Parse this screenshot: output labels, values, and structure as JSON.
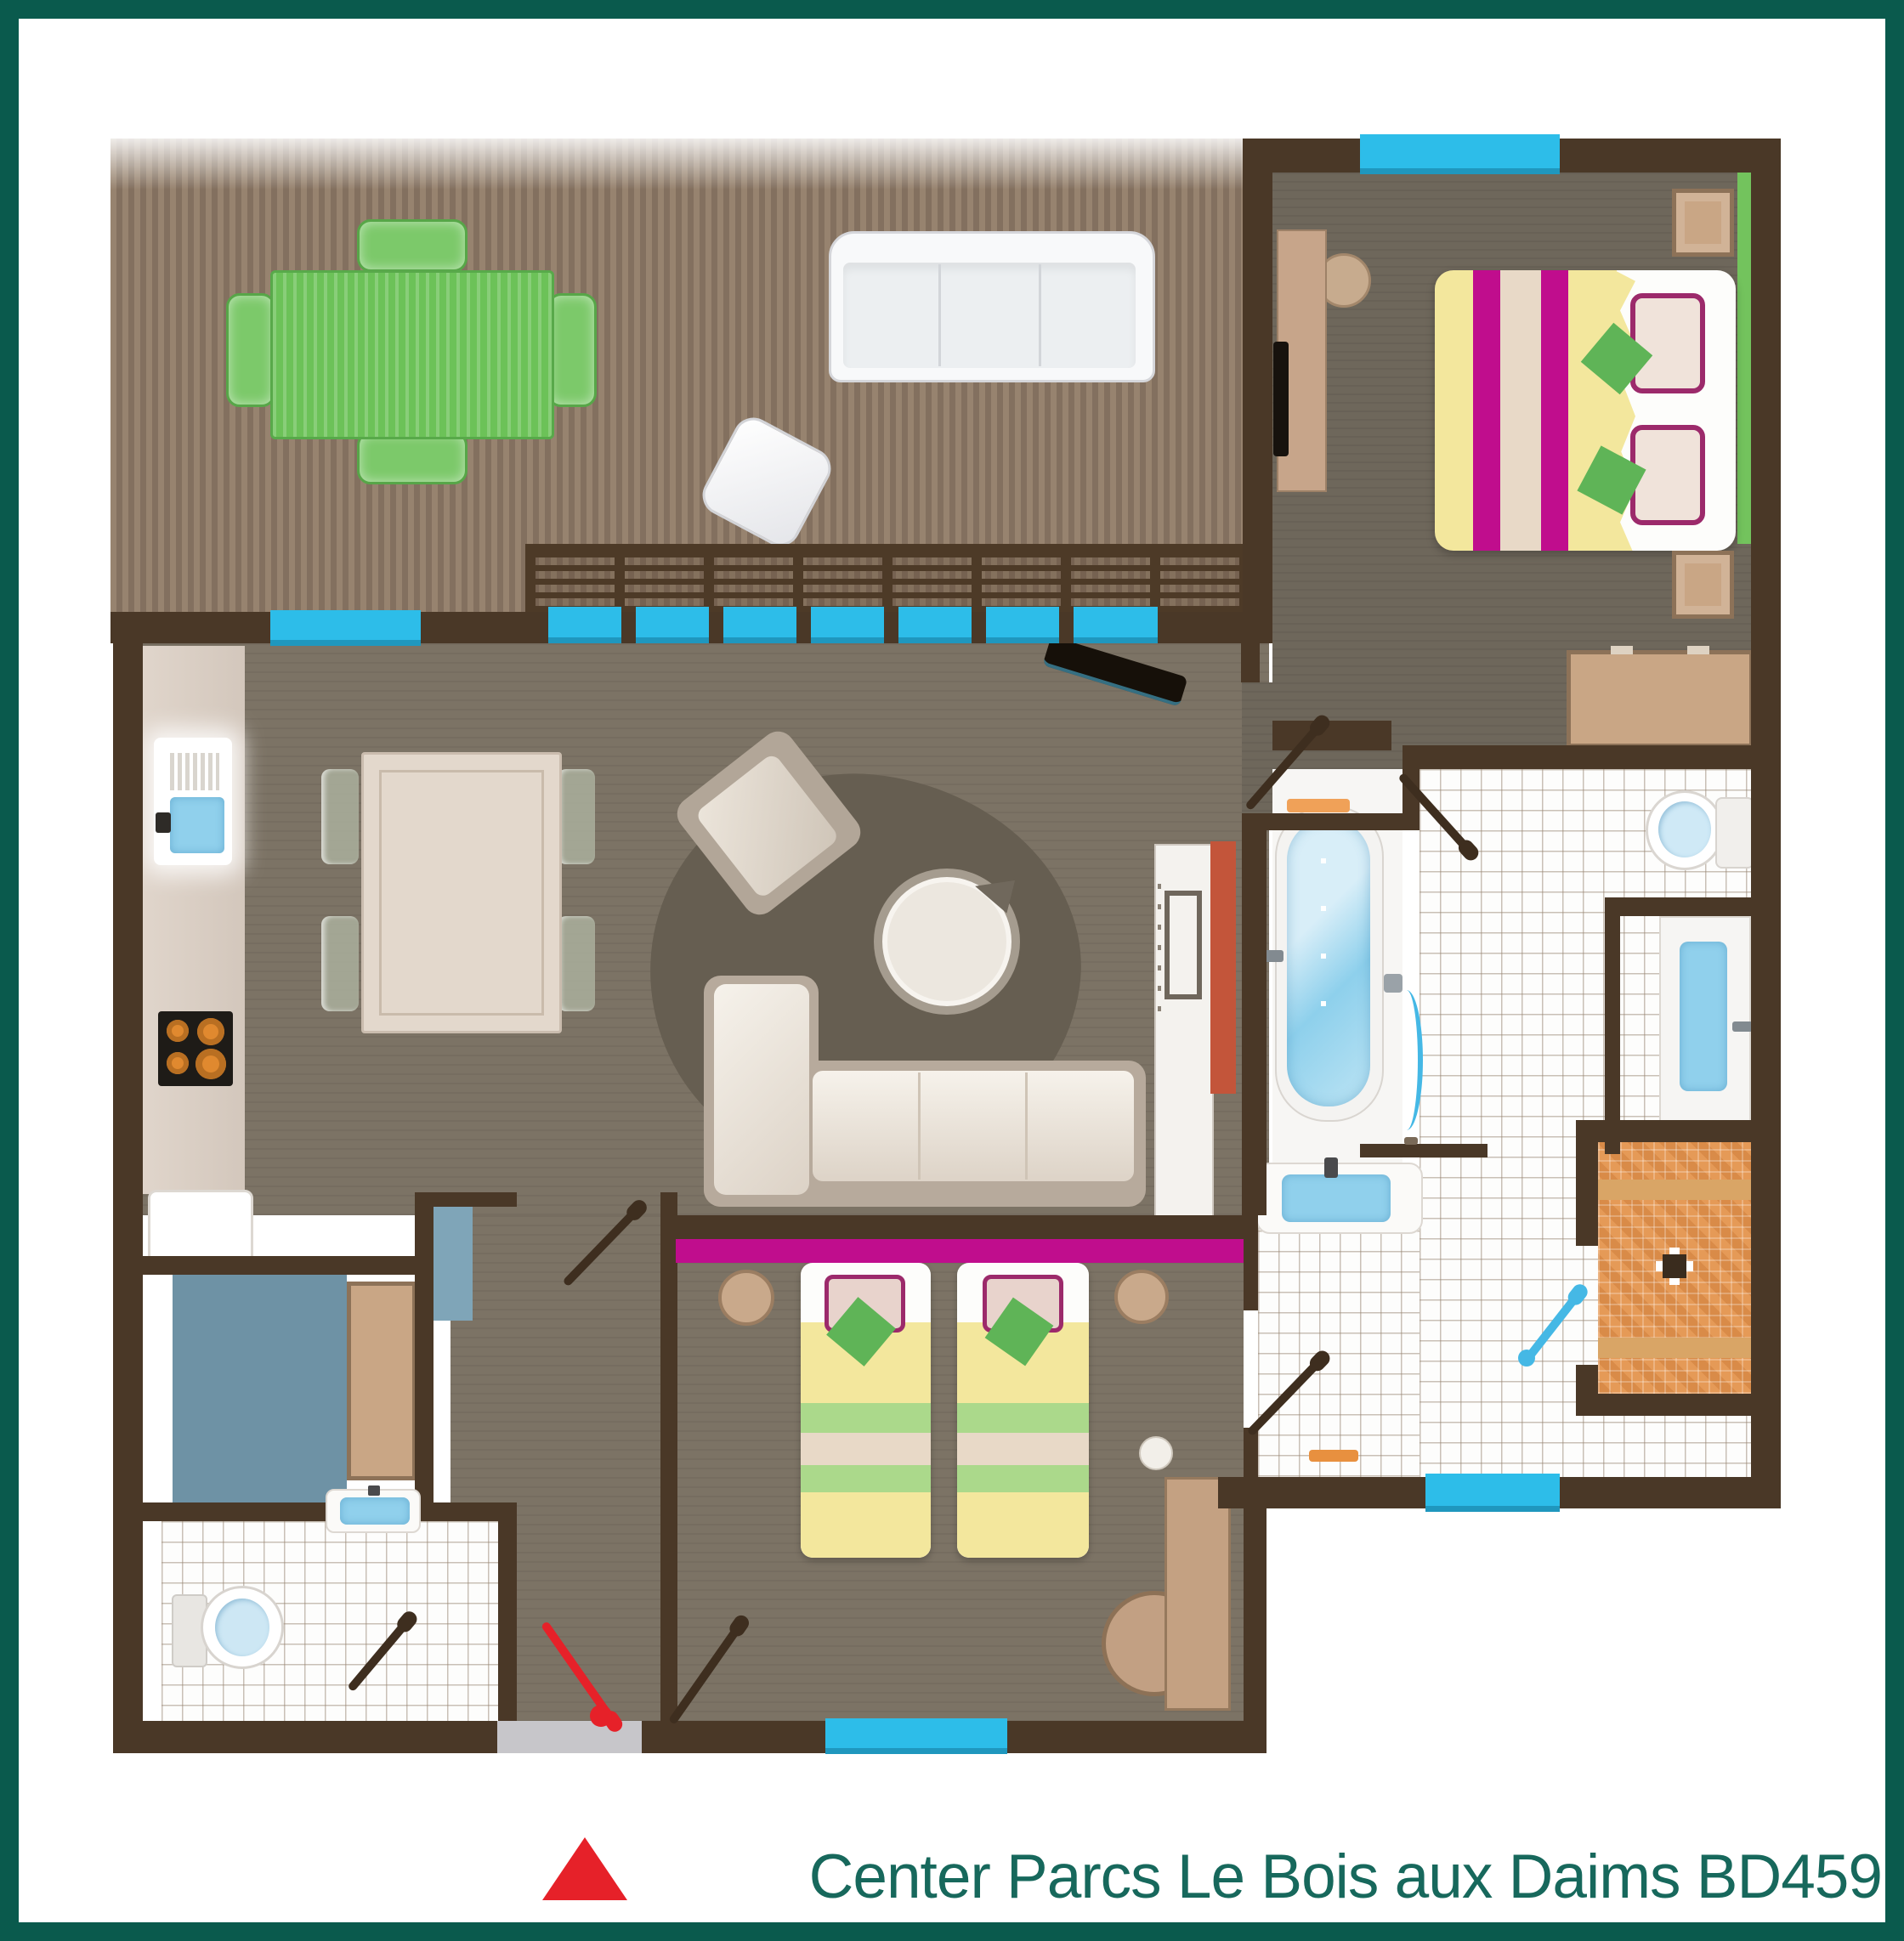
{
  "caption": {
    "text": "Center Parcs Le Bois aux Daims BD459"
  },
  "markers": {
    "entrance": "red-triangle"
  },
  "palette": {
    "frame_teal": "#0a5a4d",
    "caption_teal": "#17685c",
    "wall_brown": "#4a3827",
    "floor_gray": "#7c7365",
    "bedroom_floor": "#6e675b",
    "deck_light": "#97836f",
    "deck_dark": "#83705f",
    "window_cyan": "#2dbde9",
    "accent_magenta": "#c00d8d",
    "duvet_yellow": "#f3e79d",
    "stripe_beige": "#e8d9c7",
    "cushion_green": "#5fb457",
    "rug_green": "#73c35d",
    "table_green": "#6cc258",
    "shower_orange": "#e59a57",
    "fixture_blue": "#90d0ec",
    "storage_blue": "#6e92a5",
    "entrance_red": "#e62129",
    "furniture_tan": "#c9a685",
    "sofa_cream": "#efe9e0"
  }
}
